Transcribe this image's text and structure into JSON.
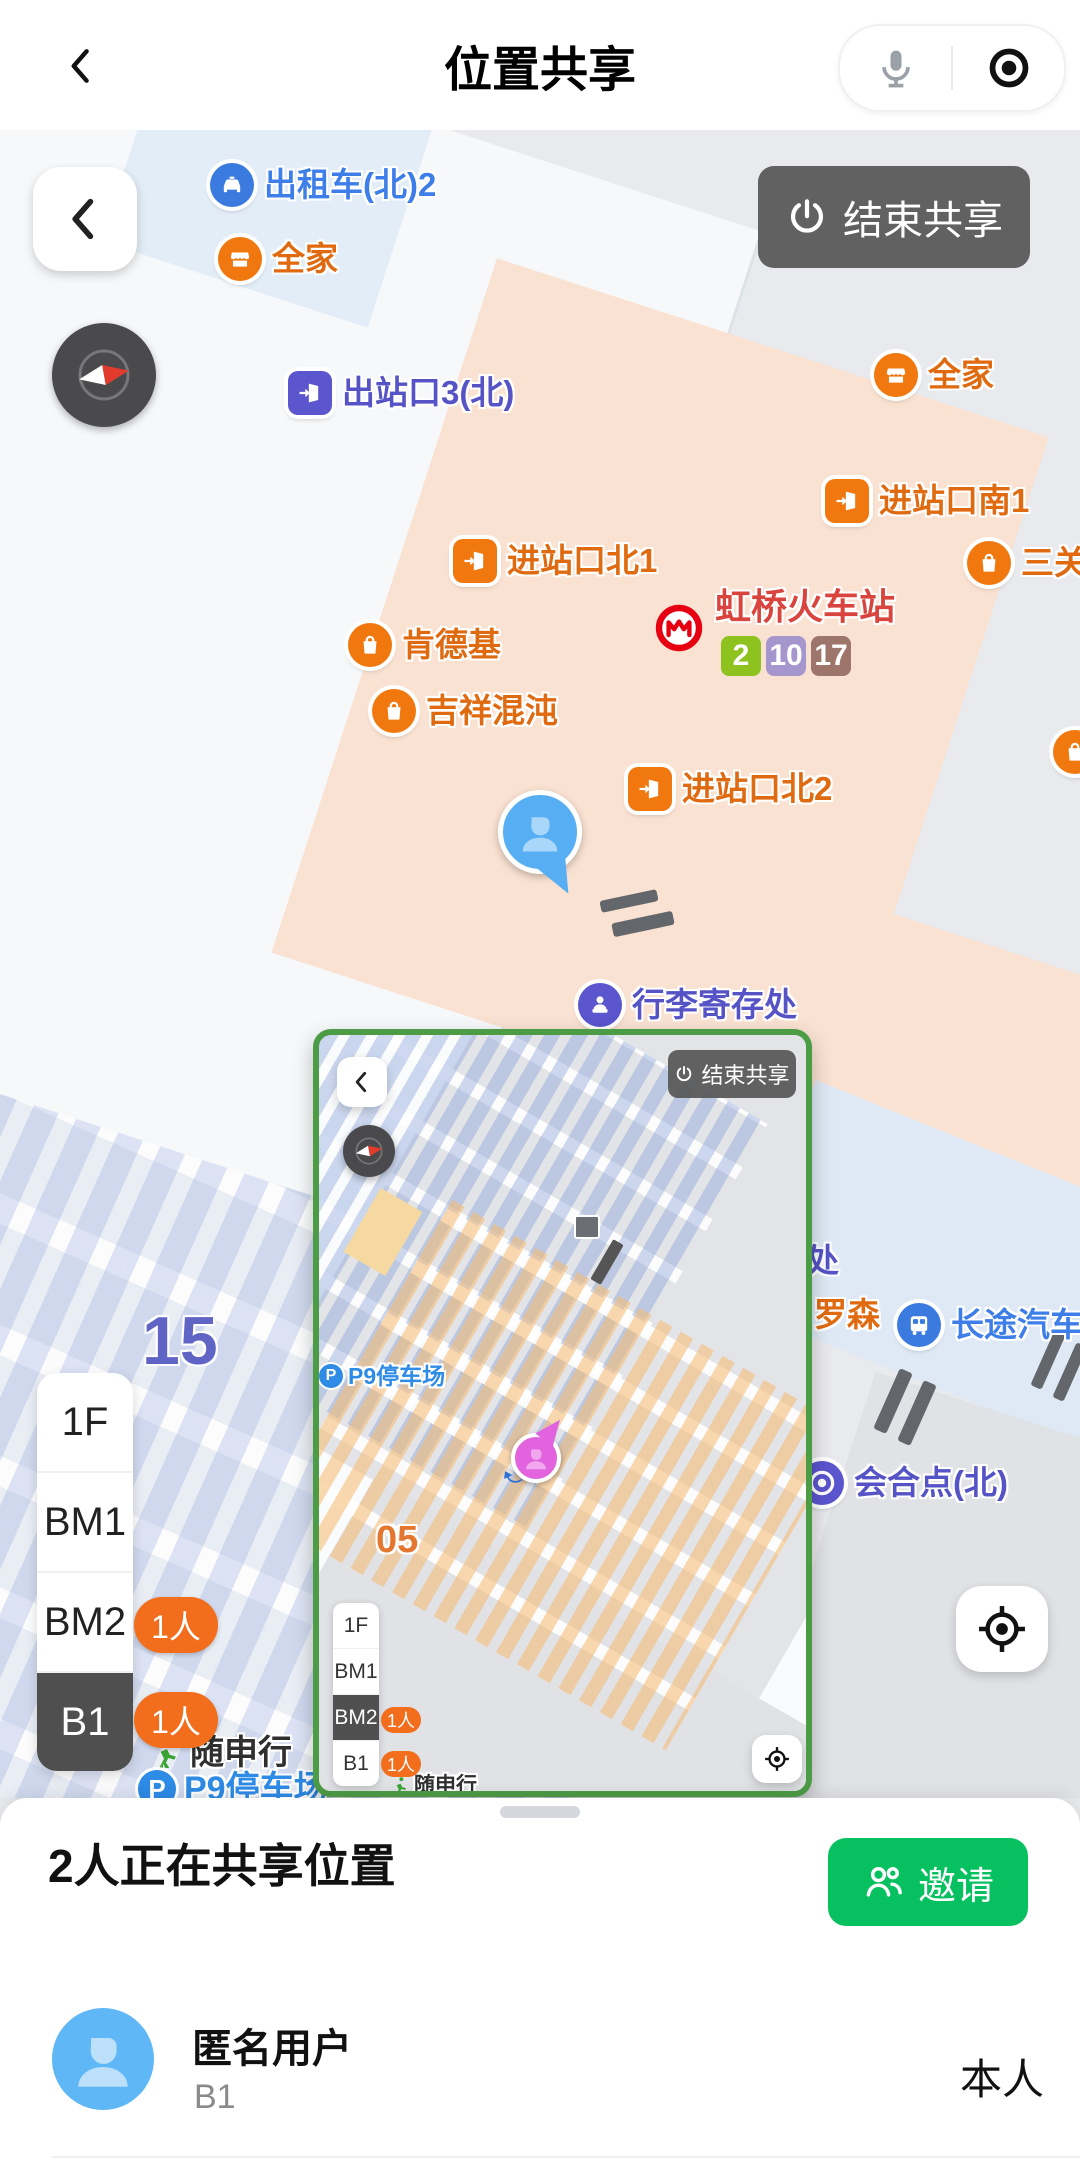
{
  "header": {
    "title": "位置共享"
  },
  "map": {
    "end_share_label": "结束共享",
    "big_zone_label": "15",
    "pois": {
      "taxi_north_2": "出租车(北)2",
      "familymart_top": "全家",
      "exit_3_north": "出站口3(北)",
      "familymart_right": "全家",
      "entrance_south_1": "进站口南1",
      "san_partial": "三关",
      "entrance_north_1": "进站口北1",
      "kfc": "肯德基",
      "jixiang_wonton": "吉祥混沌",
      "entrance_north_2": "进站口北2",
      "luggage_storage": "行李寄存处",
      "chu_partial": "处",
      "lawson": "罗森",
      "coach_bus": "长途汽车站",
      "meeting_point_north": "会合点(北)"
    },
    "station": {
      "name": "虹桥火车站",
      "lines": [
        "2",
        "10",
        "17"
      ],
      "line_colors": [
        "#8DC21F",
        "#A596CE",
        "#9E756B"
      ]
    },
    "floor_selector": {
      "floors": [
        "1F",
        "BM1",
        "BM2",
        "B1"
      ],
      "selected": "B1",
      "bm2_badge": "1人",
      "b1_badge": "1人"
    },
    "brand": {
      "suishenxing": "随申行",
      "p9": "P9停车场"
    }
  },
  "inset": {
    "end_share_label": "结束共享",
    "p9": "P9停车场",
    "zone": "05",
    "floors": [
      "1F",
      "BM1",
      "BM2",
      "B1"
    ],
    "selected": "BM2",
    "bm2_badge": "1人",
    "b1_badge": "1人",
    "brand": "随申行"
  },
  "sheet": {
    "title": "2人正在共享位置",
    "invite_label": "邀请",
    "user": {
      "name": "匿名用户",
      "floor": "B1",
      "tag": "本人"
    }
  },
  "colors": {
    "wechat_green": "#07C160",
    "inset_border_green": "#4C9B45",
    "poi_orange": "#F0780F",
    "poi_blue": "#3B7BE0",
    "poi_indigo": "#5B55CE",
    "station_red": "#D9443E",
    "self_marker_blue": "#57AEF3",
    "peer_marker_pink": "#E163DE",
    "count_pill_orange": "#F26E1D"
  }
}
